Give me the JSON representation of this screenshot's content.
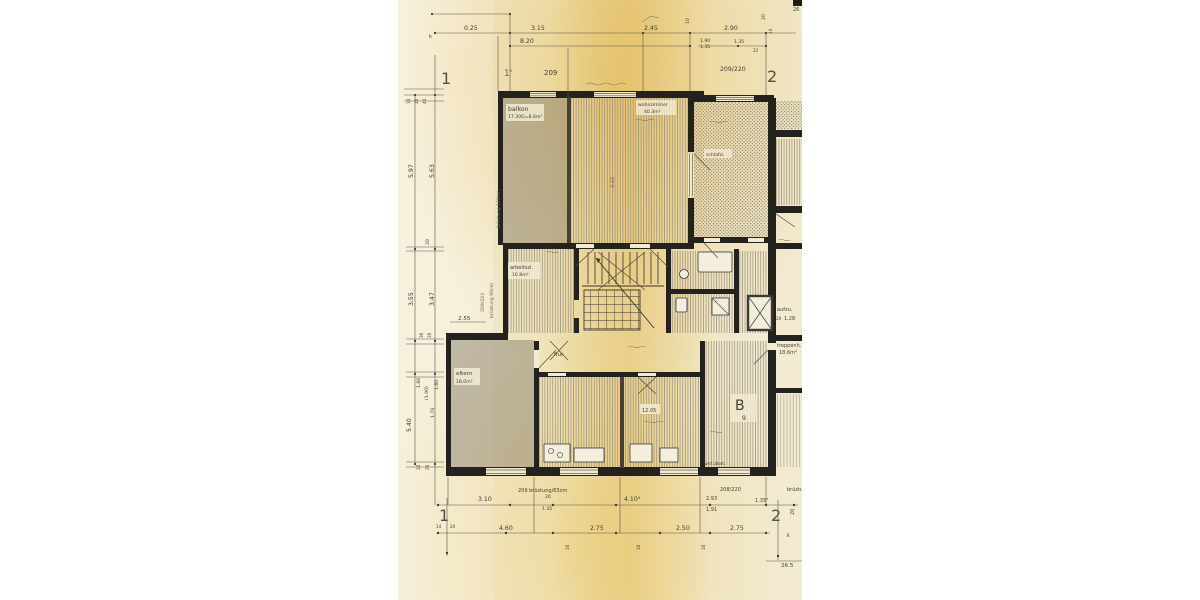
{
  "axes": {
    "tl": "1",
    "tlp": "1'",
    "tr": "2",
    "bl": "1",
    "br": "2"
  },
  "d": {
    "t025": "0.25",
    "t315": "3.15",
    "t245": "2.45",
    "t290": "2.90",
    "t820": "8.20",
    "t190": "1.90",
    "t135a": "1.35",
    "t135b": "1.35",
    "t10": "10",
    "t20": "20",
    "t22": "22",
    "t14": "14",
    "t26": "26",
    "l14": "14",
    "l20": "20",
    "l44": "44",
    "l597": "5.97",
    "l563": "5.63",
    "l20b": "20",
    "l355": "3.55",
    "l347": "3.47",
    "l36": "36",
    "l20c": "20",
    "l186": "1.86",
    "l190": "(1.90)",
    "l180": "1.80",
    "l540": "5.40",
    "l176": "1.76",
    "l20d": "20",
    "l26": "26",
    "k1": "k",
    "k2": "k",
    "v222": "2.22",
    "h255": "2.55",
    "b310": "3.10",
    "b20": "20",
    "b135": "1.35",
    "b410": "4.10⁵",
    "b293": "2.93",
    "b191": "1.91",
    "b135s": "1.35⁵",
    "b20r": "20",
    "b460": "4.60",
    "b275a": "2.75",
    "b250": "2.50",
    "b275b": "2.75",
    "b10a": "10",
    "b10b": "10",
    "b10c": "10",
    "g14": "14",
    "g20": "20",
    "b265": "26.5"
  },
  "codes": {
    "tl": "209",
    "tr": "209/220",
    "bl": "209 brüstung/65cm",
    "br": "208/220",
    "brc": "brüstu"
  },
  "rooms": {
    "balkon1": "balkon",
    "balkon2": "17.30G=8.6m²",
    "wohn1": "wohnzimmer",
    "wohn2": "40.3m²",
    "schlaf": "schlafzi.",
    "arbeit1": "arbeitszi.",
    "arbeit2": "16.8m²",
    "eltern1": "eltern",
    "eltern2": "18.0m²",
    "flur": "flur",
    "kind": "12.05",
    "bsym": "B",
    "b9": "9",
    "aufzug": "aufzu.",
    "aufzug2": "1.28",
    "aufzug3": "20",
    "trep1": "treppenh.",
    "trep2": "18.6m²",
    "wirt": "wirt.abst.",
    "vbr120": "brüstung 120cm",
    "vbr90": "brüstung 90cm",
    "v209": "209/223"
  }
}
